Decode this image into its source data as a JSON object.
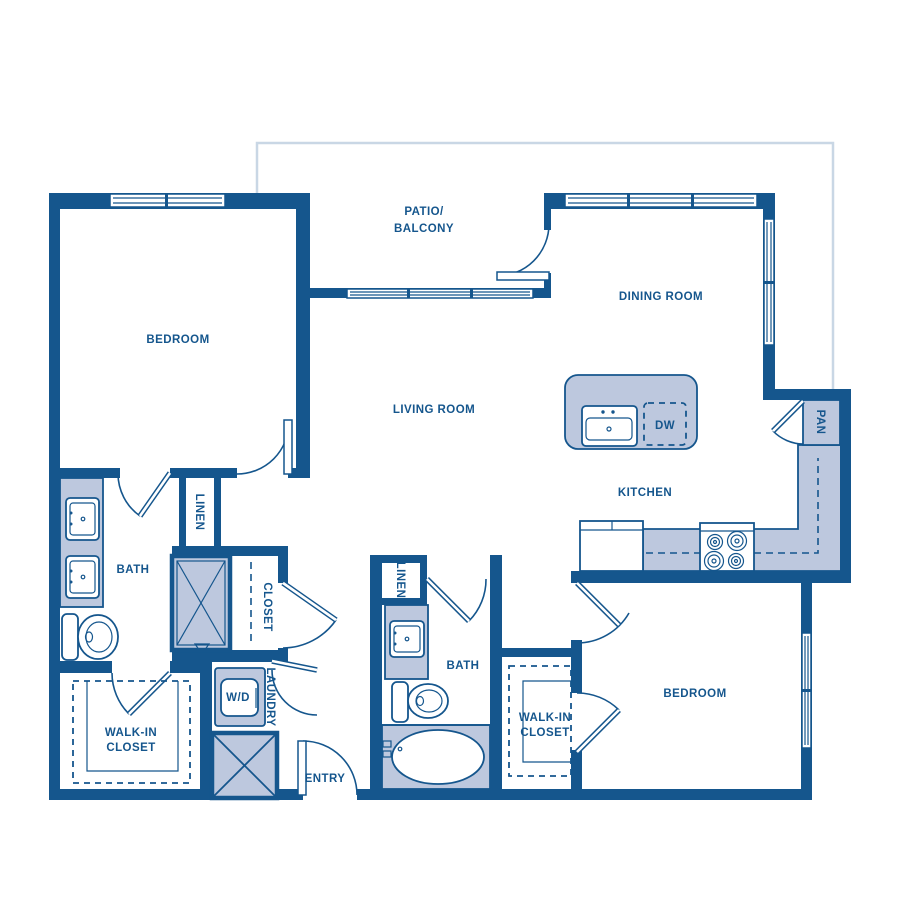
{
  "floorplan": {
    "rooms": {
      "bedroom1": {
        "label": "BEDROOM"
      },
      "patio": {
        "label_line1": "PATIO/",
        "label_line2": "BALCONY"
      },
      "dining": {
        "label": "DINING ROOM"
      },
      "living": {
        "label": "LIVING ROOM"
      },
      "kitchen": {
        "label": "KITCHEN"
      },
      "pantry": {
        "label": "PAN"
      },
      "bath1": {
        "label": "BATH"
      },
      "linen1": {
        "label": "LINEN"
      },
      "closet_hall": {
        "label": "CLOSET"
      },
      "walkin1": {
        "label_line1": "WALK-IN",
        "label_line2": "CLOSET"
      },
      "laundry": {
        "label": "LAUNDRY"
      },
      "entry": {
        "label": "ENTRY"
      },
      "bath2": {
        "label": "BATH"
      },
      "linen2": {
        "label": "LINEN"
      },
      "walkin2": {
        "label_line1": "WALK-IN",
        "label_line2": "CLOSET"
      },
      "bedroom2": {
        "label": "BEDROOM"
      }
    },
    "appliances": {
      "dishwasher": {
        "label": "DW"
      },
      "washer_dryer": {
        "label": "W/D"
      }
    },
    "colors": {
      "wall": "#15568d",
      "fixture_fill": "#bdc8de",
      "exterior_line": "#c9d7e5",
      "background": "#ffffff"
    }
  }
}
